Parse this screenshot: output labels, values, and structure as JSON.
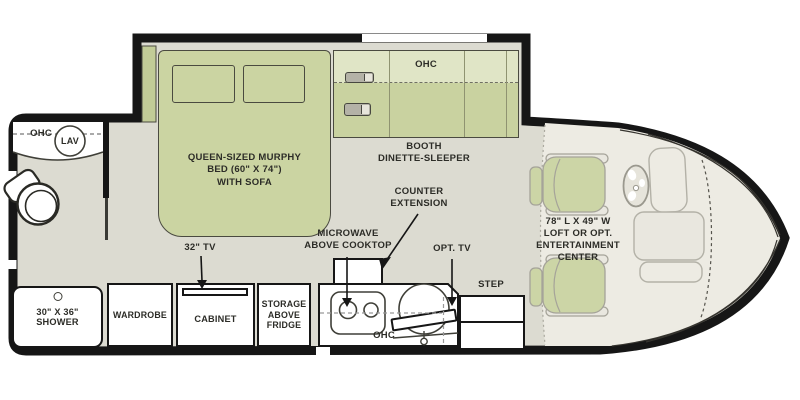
{
  "title": "RV floor plan",
  "colors": {
    "wall": "#161616",
    "floor": "#dcdbd1",
    "cab_floor": "#edebe3",
    "green": "#cbd4a2",
    "green_light": "#e0e5c6",
    "white": "#ffffff"
  },
  "bathroom": {
    "ohc": "OHC",
    "lav": "LAV"
  },
  "shower": {
    "size": "30\" X 36\"",
    "name": "SHOWER"
  },
  "bedroom": {
    "tv_label": "32\" TV",
    "bed_l1": "QUEEN-SIZED MURPHY",
    "bed_l2": "BED (60\" X 74\")",
    "bed_l3": "WITH SOFA"
  },
  "storage_row": {
    "wardrobe": "WARDROBE",
    "cabinet": "CABINET",
    "fridge_l1": "STORAGE",
    "fridge_l2": "ABOVE",
    "fridge_l3": "FRIDGE"
  },
  "dinette": {
    "ohc": "OHC",
    "booth_l1": "BOOTH",
    "booth_l2": "DINETTE-SLEEPER"
  },
  "kitchen": {
    "micro_l1": "MICROWAVE",
    "micro_l2": "ABOVE COOKTOP",
    "counterext_l1": "COUNTER",
    "counterext_l2": "EXTENSION",
    "opt_tv": "OPT. TV",
    "ohc": "OHC"
  },
  "entry": {
    "step": "STEP"
  },
  "cab": {
    "l1": "78\" L X 49\" W",
    "l2": "LOFT OR OPT.",
    "l3": "ENTERTAINMENT",
    "l4": "CENTER"
  }
}
